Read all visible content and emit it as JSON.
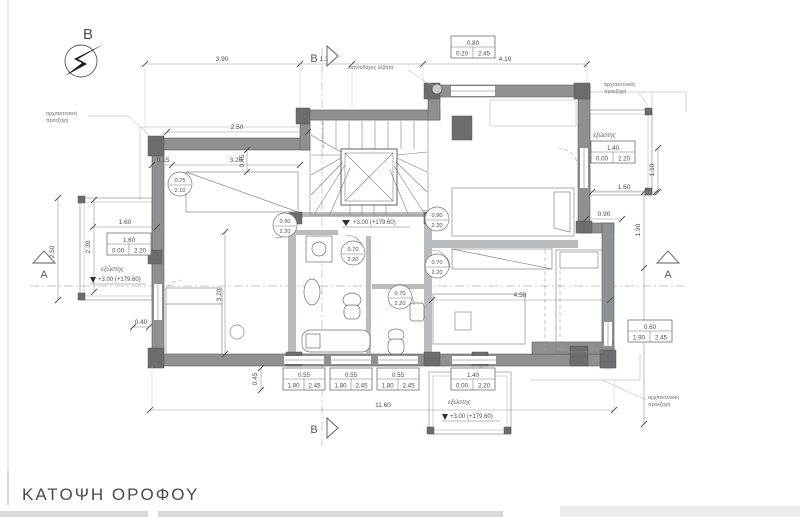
{
  "title": "ΚΑΤΟΨΗ ΟΡΟΦΟΥ",
  "north": {
    "label": "B"
  },
  "sections": {
    "a": "A",
    "b": "B"
  },
  "levels": {
    "floor": "+3.00 (+179.60)",
    "balcony_left": "+3.00 (+179.60)",
    "balcony_bottom": "+3.00 (+179.60)",
    "balcony_label": "εξώστης"
  },
  "notes": {
    "overhang_line1": "αρχιτεκτονική",
    "overhang_line2": "προεξοχή",
    "chimney": "καπνοδόχος λέβητα"
  },
  "dims": {
    "top1": "3.90",
    "top2": "1.30",
    "top3": "4.10",
    "tl1": "2.50",
    "tl2": "3.20",
    "tl3": "0.15",
    "tl4": "0.45",
    "lbal_w": "1.60",
    "lbal_h": "2.30",
    "louter": "2.50",
    "room1_h": "3.20",
    "small1": "0.40",
    "rbal_w": "1.60",
    "rbal_h": "1.10",
    "r1": "0.90",
    "r2": "1.90",
    "r3": "3.90",
    "room2_w": "4.50",
    "bottom_total": "11.60",
    "small2": "0.45"
  },
  "door_tags": [
    {
      "w": "0.75",
      "h": "2.10"
    },
    {
      "w": "0.90",
      "h": "2.20"
    },
    {
      "w": "0.90",
      "h": "2.20"
    },
    {
      "w": "0.70",
      "h": "2.20"
    },
    {
      "w": "0.70",
      "h": "2.20"
    },
    {
      "w": "0.70",
      "h": "2.20"
    }
  ],
  "schedules": [
    {
      "w": "0.80",
      "sill": "0.20",
      "head": "2.45"
    },
    {
      "w": "1.40",
      "sill": "0.00",
      "head": "2.20"
    },
    {
      "w": "1.60",
      "sill": "0.00",
      "head": "2.20"
    },
    {
      "w": "0.60",
      "sill": "1.90",
      "head": "2.45"
    },
    {
      "w": "0.55",
      "sill": "1.80",
      "head": "2.45"
    },
    {
      "w": "0.55",
      "sill": "1.80",
      "head": "2.45"
    },
    {
      "w": "0.55",
      "sill": "1.80",
      "head": "2.45"
    },
    {
      "w": "1.40",
      "sill": "0.00",
      "head": "2.20"
    }
  ],
  "colors": {
    "wall": "#8e9091",
    "column": "#6a6c6d",
    "line": "#4f5254",
    "dim": "#8f9295",
    "paper": "#ffffff",
    "title_text": "#4a4a4a"
  }
}
